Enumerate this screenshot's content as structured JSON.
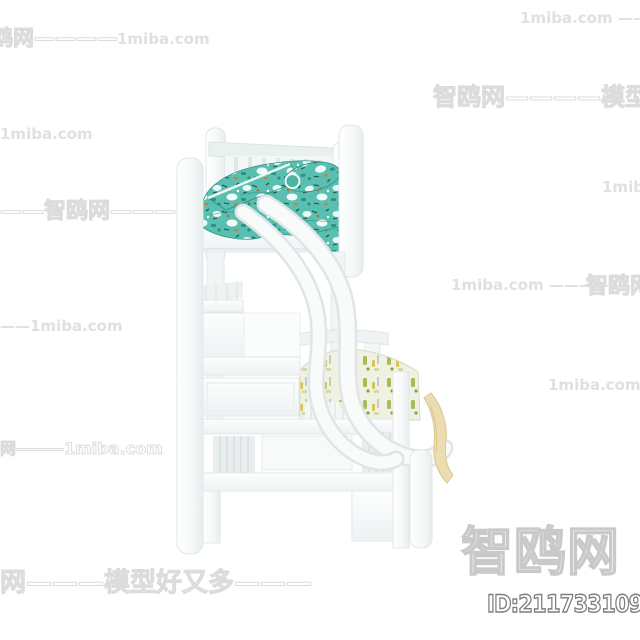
{
  "site": {
    "logo_text": "智鸥网",
    "model_id": "ID:211733109"
  },
  "watermarks": [
    {
      "text": "1miba.com ———————",
      "x": 520,
      "y": 11,
      "size": 15,
      "style": "solid"
    },
    {
      "text": "鸥网————",
      "x": -8,
      "y": 28,
      "size": 21,
      "style": "outline"
    },
    {
      "text": "1miba.com",
      "x": 117,
      "y": 32,
      "size": 15,
      "style": "solid"
    },
    {
      "text": "智鸥网————模型好又多",
      "x": 433,
      "y": 85,
      "size": 24,
      "style": "outline"
    },
    {
      "text": "1miba.com",
      "x": 0,
      "y": 127,
      "size": 15,
      "style": "solid"
    },
    {
      "text": "1miba.com",
      "x": 602,
      "y": 180,
      "size": 15,
      "style": "solid"
    },
    {
      "text": "——智鸥网———",
      "x": 0,
      "y": 201,
      "size": 22,
      "style": "outline"
    },
    {
      "text": "1miba.com —————",
      "x": 451,
      "y": 278,
      "size": 15,
      "style": "solid"
    },
    {
      "text": "智鸥网",
      "x": 586,
      "y": 276,
      "size": 22,
      "style": "outline"
    },
    {
      "text": "——1miba.com",
      "x": 0,
      "y": 319,
      "size": 15,
      "style": "solid"
    },
    {
      "text": "1miba.com ————",
      "x": 548,
      "y": 378,
      "size": 15,
      "style": "solid"
    },
    {
      "text": "网———1miba.com",
      "x": 0,
      "y": 441,
      "size": 16,
      "style": "outline"
    },
    {
      "text": "网———模型好又多———",
      "x": 0,
      "y": 570,
      "size": 26,
      "style": "outline"
    }
  ],
  "colors": {
    "background": "#ffffff",
    "bedding_top_teal": "#59bfb1",
    "bedding_bottom_cream": "#f0f1e1",
    "frame_white": "#f8fafa",
    "watermark_gray": "#e0e0e0",
    "logo_outline": "#c9c9c9",
    "id_outline": "#7d7d7d",
    "foot_drape_tan": "#ecdcb2"
  }
}
